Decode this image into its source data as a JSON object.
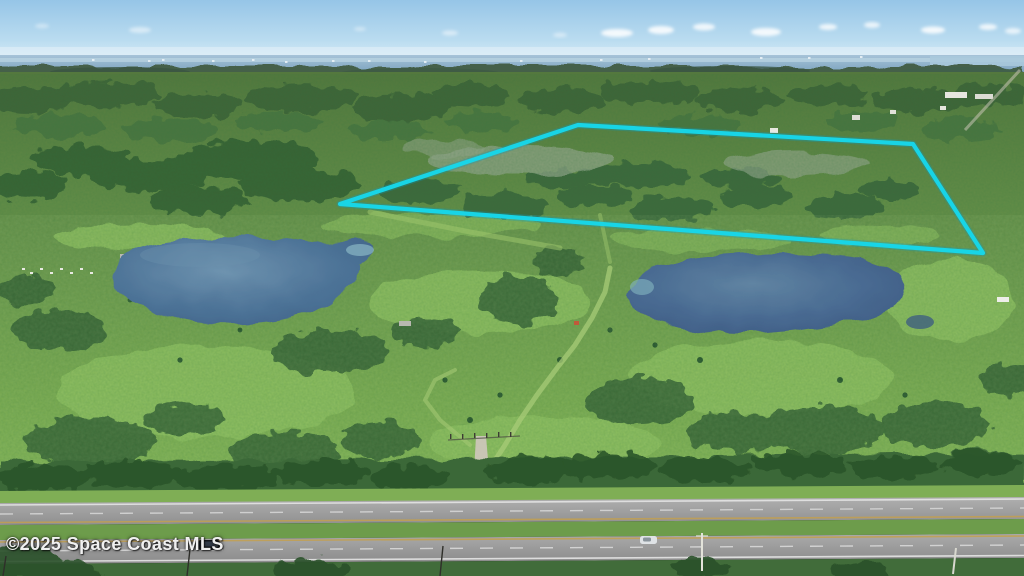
{
  "watermark": {
    "text": "©2025 Space Coast MLS"
  },
  "boundary": {
    "color": "#17d7ea",
    "points": "340,204 578,125 913,144 983,253",
    "shape": "four-sided highlighted parcel outline"
  },
  "palette": {
    "sky": "#96c5e7",
    "distant_water": "#8fb3cc",
    "forest_dark": "#3c6238",
    "pasture_light": "#8fc05e",
    "pond_left": "#4d7397",
    "pond_right": "#45668c",
    "asphalt": "#a2a2a2",
    "median_grass": "#6d9c4b",
    "driveway_sand": "#cbc6b8",
    "dark_car": "#15181d",
    "white_car": "#dfe3e6"
  },
  "scene": {
    "elements": "sky, clouds, distant water strip, tree line, cyan parcel boundary, two ponds, grass trails, sandy entry driveway with gate, divided highway with two vehicles, utility poles"
  }
}
